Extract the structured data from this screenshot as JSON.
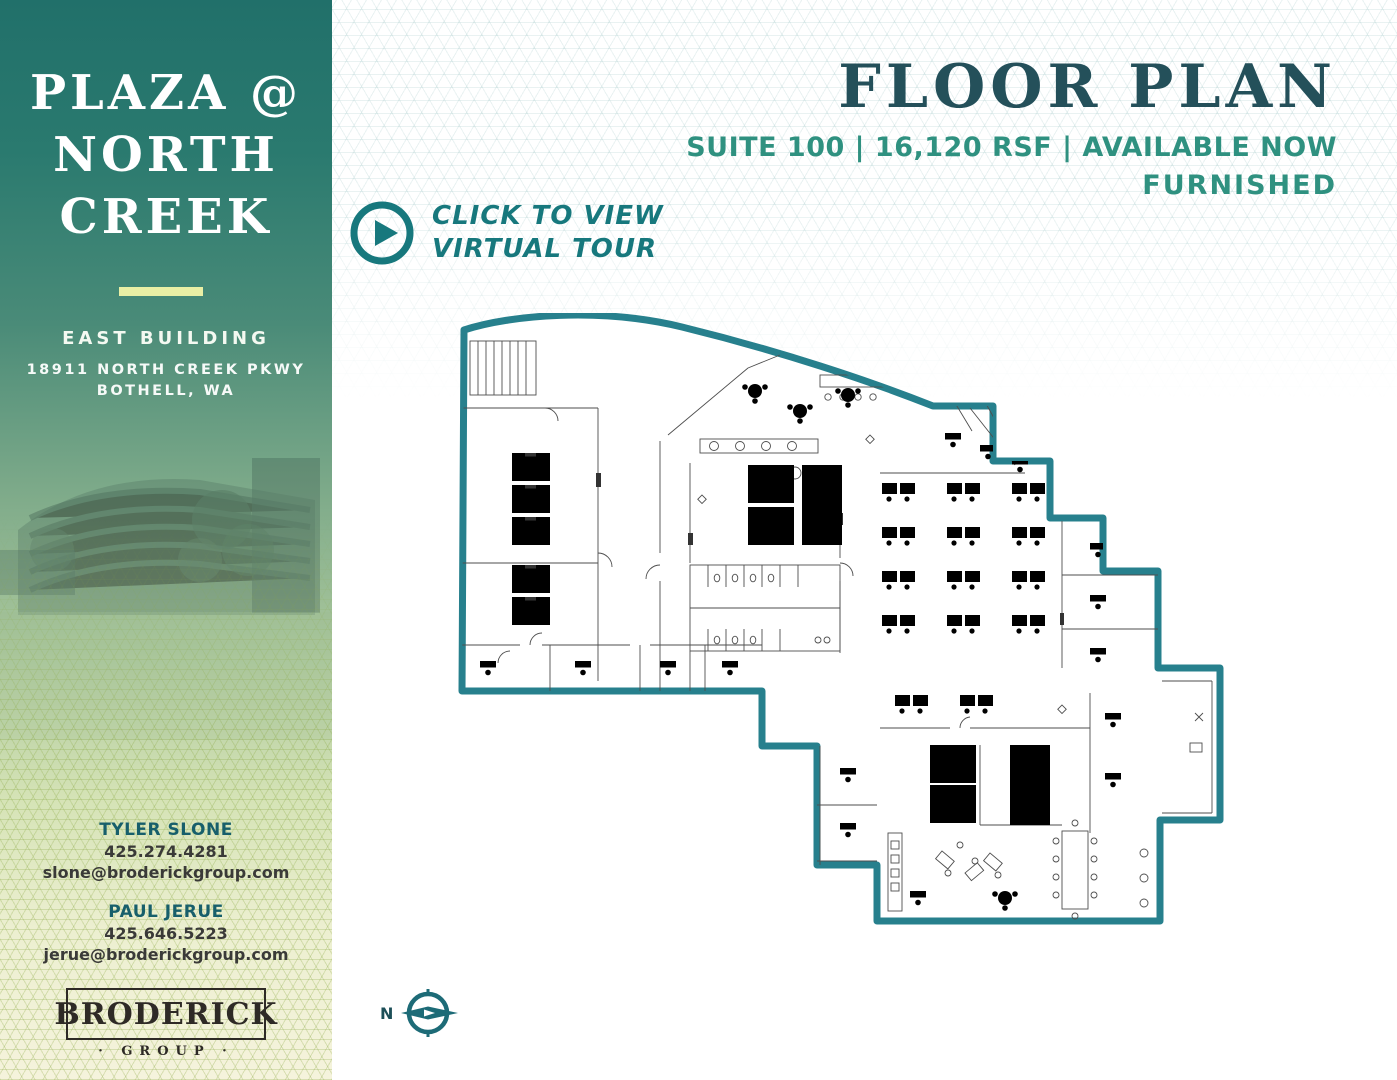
{
  "sidebar": {
    "title": {
      "line1": "PLAZA @",
      "line2": "NORTH",
      "line3": "CREEK"
    },
    "building_name": "EAST BUILDING",
    "address_line1": "18911 NORTH CREEK PKWY",
    "address_line2": "BOTHELL, WA",
    "contacts": [
      {
        "name": "TYLER SLONE",
        "phone": "425.274.4281",
        "email": "slone@broderickgroup.com"
      },
      {
        "name": "PAUL JERUE",
        "phone": "425.646.5223",
        "email": "jerue@broderickgroup.com"
      }
    ],
    "logo": {
      "wordmark": "BRODERICK",
      "subtitle": "· GROUP ·"
    }
  },
  "header": {
    "title": "FLOOR PLAN",
    "details": "SUITE 100 | 16,120 RSF | AVAILABLE NOW",
    "availability": "FURNISHED"
  },
  "virtual_tour": {
    "line1": "CLICK TO VIEW",
    "line2": "VIRTUAL TOUR"
  },
  "compass": {
    "north_label": "N"
  },
  "colors": {
    "plan_outline_teal": "#27808d",
    "header_dark_teal": "#24505a",
    "header_green": "#2f9180",
    "tour_teal": "#17787d",
    "sidebar_top": "#21706a",
    "sidebar_bottom": "#f5f3dc",
    "divider_accent": "#e9efa5"
  }
}
